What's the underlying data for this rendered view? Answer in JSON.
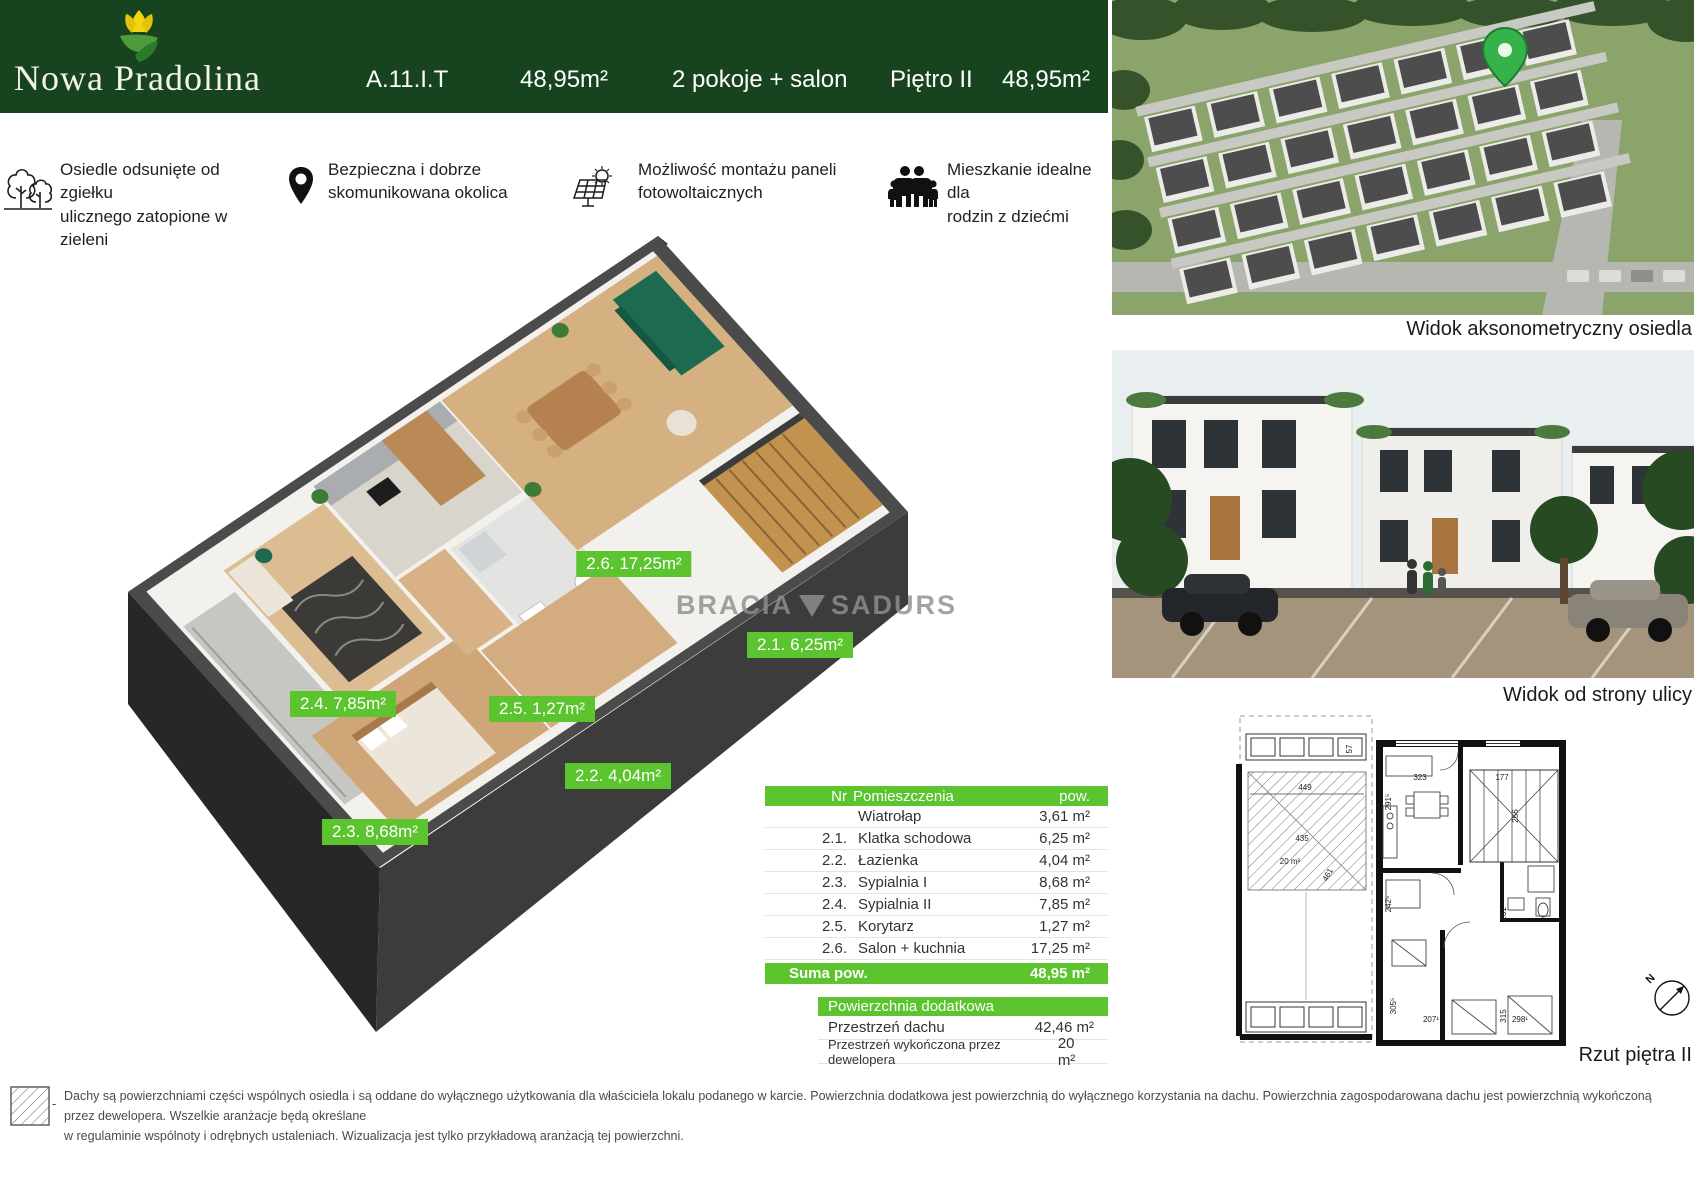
{
  "colors": {
    "header_green": "#17431f",
    "accent_green": "#5bc42e"
  },
  "header": {
    "brand": "Nowa Pradolina",
    "unit": "A.11.I.T",
    "area": "48,95m²",
    "rooms": "2 pokoje + salon",
    "floor": "Piętro II",
    "area_repeat": "48,95m²"
  },
  "features": [
    {
      "icon": "trees-icon",
      "text": "Osiedle odsunięte od zgiełku\nulicznego zatopione w zieleni"
    },
    {
      "icon": "location-pin-icon",
      "text": "Bezpieczna i dobrze\nskomunikowana okolica"
    },
    {
      "icon": "solar-panel-icon",
      "text": "Możliwość montażu paneli\nfotowoltaicznych"
    },
    {
      "icon": "family-icon",
      "text": "Mieszkanie idealne dla\nrodzin z dziećmi"
    }
  ],
  "plan3d": {
    "watermark_left": "BRACIA",
    "watermark_right": "SADURS",
    "labels": [
      {
        "text": "2.6. 17,25m²"
      },
      {
        "text": "2.1. 6,25m²"
      },
      {
        "text": "2.4. 7,85m²"
      },
      {
        "text": "2.5. 1,27m²"
      },
      {
        "text": "2.2. 4,04m²"
      },
      {
        "text": "2.3. 8,68m²"
      }
    ]
  },
  "tables": {
    "rooms": {
      "headers": {
        "nr": "Nr",
        "name": "Pomieszczenia",
        "area": "pow."
      },
      "rows": [
        {
          "nr": "",
          "name": "Wiatrołap",
          "area": "3,61 m²"
        },
        {
          "nr": "2.1.",
          "name": "Klatka schodowa",
          "area": "6,25 m²"
        },
        {
          "nr": "2.2.",
          "name": "Łazienka",
          "area": "4,04 m²"
        },
        {
          "nr": "2.3.",
          "name": "Sypialnia I",
          "area": "8,68 m²"
        },
        {
          "nr": "2.4.",
          "name": "Sypialnia II",
          "area": "7,85 m²"
        },
        {
          "nr": "2.5.",
          "name": "Korytarz",
          "area": "1,27 m²"
        },
        {
          "nr": "2.6.",
          "name": "Salon + kuchnia",
          "area": "17,25 m²"
        }
      ],
      "sum_label": "Suma pow.",
      "sum_value": "48,95 m²"
    },
    "additional": {
      "header": "Powierzchnia dodatkowa",
      "rows": [
        {
          "name": "Przestrzeń dachu",
          "value": "42,46 m²"
        },
        {
          "name": "Przestrzeń wykończona przez dewelopera",
          "value": "20 m²"
        }
      ]
    }
  },
  "captions": {
    "aerial": "Widok aksonometryczny osiedla",
    "street": "Widok od strony ulicy",
    "plan": "Rzut piętra II"
  },
  "technical_plan": {
    "area_label": "20 m²",
    "dims": {
      "d449": "449",
      "d435": "435",
      "d461": "461",
      "d57": "57",
      "d323": "323",
      "d177": "177",
      "d2915": "291⁵",
      "d256": "256",
      "d2425": "242⁵",
      "d231": "231",
      "d3055": "305⁵",
      "d315": "315",
      "d2071": "207¹",
      "d2981": "298¹"
    },
    "compass": "N"
  },
  "disclaimer": {
    "dash": "-",
    "text": "Dachy są powierzchniami części wspólnych osiedla i są oddane do wyłącznego użytkowania dla właściciela lokalu podanego w karcie. Powierzchnia dodatkowa jest powierzchnią do wyłącznego korzystania na dachu. Powierzchnia zagospodarowana dachu jest powierzchnią wykończoną przez dewelopera. Wszelkie aranżacje będą określane\nw regulaminie wspólnoty i odrębnych ustaleniach. Wizualizacja jest tylko przykładową aranżacją tej powierzchni."
  }
}
